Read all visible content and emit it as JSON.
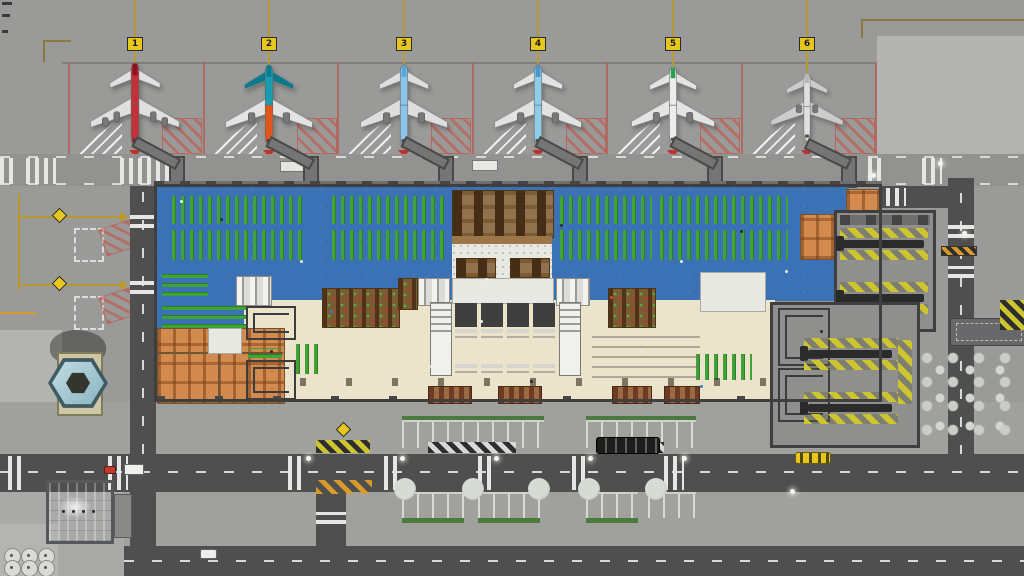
{
  "scene": {
    "type": "airport-management-game",
    "view": "top-down terminal overview"
  },
  "colors": {
    "apron": "#9a9a98",
    "concrete_light": "#b3b3b0",
    "pavement": "#a0a09d",
    "road": "#4f4f4f",
    "service_road": "#929290",
    "wall": "#3f3f3f",
    "blue_floor": "#3b72b5",
    "seat_green": "#3fa337",
    "seat_green_dark": "#2c7d26",
    "cream_floor": "#ece3cb",
    "office_orange": "#d28a4e",
    "shop_brown": "#7c5a33",
    "table_dark": "#452e15",
    "white_floor": "#e9e9e4",
    "gray_floor": "#8f8f8d",
    "hazard_yellow": "#cdc52f",
    "hazard_orange": "#d79a2b",
    "belt_dark": "#2b2b2b",
    "stand_line_red": "#b25b52",
    "marking_white": "#e6e6e4",
    "taxi_yellow": "#b99a28",
    "sign_yellow": "#e7c71f",
    "glass_teal": "#b7d4c8",
    "tower_base": "#cfc6a5",
    "tree_pale": "#c9cfc8",
    "bus_dark": "#1d1d1d",
    "tan_line": "#8a7a40"
  },
  "stands": [
    {
      "sign": "1",
      "plane": {
        "rear": "#c23038",
        "body": "#c23038",
        "wing": "#e0e0e0",
        "tail": "#8c1420"
      }
    },
    {
      "sign": "2",
      "plane": {
        "rear": "#1a9cb0",
        "body": "#e2561b",
        "wing": "#e3e3e3",
        "tail": "#0d7a8c"
      }
    },
    {
      "sign": "3",
      "plane": {
        "rear": "#8bc4e6",
        "body": "#8bc4e6",
        "wing": "#dedede",
        "tail": "#5aa8d8"
      }
    },
    {
      "sign": "4",
      "plane": {
        "rear": "#90cbe9",
        "body": "#90cbe9",
        "wing": "#e2e2e2",
        "tail": "#4a97cc"
      }
    },
    {
      "sign": "5",
      "plane": {
        "rear": "#ececec",
        "body": "#ececec",
        "wing": "#e4e4e4",
        "tail": "#2f9e55"
      }
    },
    {
      "sign": "6",
      "plane": {
        "rear": "#dfdfdf",
        "body": "#dfdfdf",
        "wing": "#cccccc",
        "tail": "#b5b5b5"
      }
    }
  ]
}
